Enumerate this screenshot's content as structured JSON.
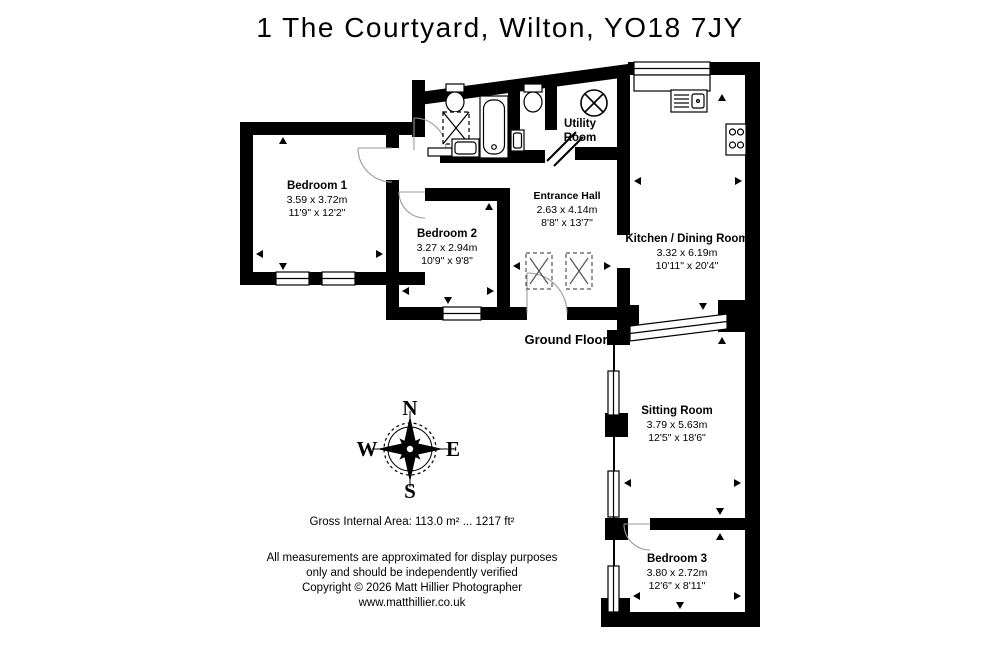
{
  "title": "1 The Courtyard, Wilton, YO18 7JY",
  "floor_label": "Ground Floor",
  "rooms": {
    "bedroom1": {
      "name": "Bedroom 1",
      "metric": "3.59 x 3.72m",
      "imperial": "11'9\" x 12'2\""
    },
    "bedroom2": {
      "name": "Bedroom 2",
      "metric": "3.27 x 2.94m",
      "imperial": "10'9\" x 9'8\""
    },
    "entrance": {
      "name": "Entrance Hall",
      "metric": "2.63 x 4.14m",
      "imperial": "8'8\" x 13'7\""
    },
    "utility": {
      "line1": "Utility",
      "line2": "Room"
    },
    "kitchen": {
      "name": "Kitchen / Dining Room",
      "metric": "3.32 x 6.19m",
      "imperial": "10'11\" x 20'4\""
    },
    "sitting": {
      "name": "Sitting Room",
      "metric": "3.79 x 5.63m",
      "imperial": "12'5\" x 18'6\""
    },
    "bedroom3": {
      "name": "Bedroom 3",
      "metric": "3.80 x 2.72m",
      "imperial": "12'6\" x 8'11\""
    }
  },
  "compass": {
    "n": "N",
    "e": "E",
    "s": "S",
    "w": "W"
  },
  "area_line": "Gross Internal Area: 113.0 m² ... 1217 ft²",
  "disclaimer": [
    "All measurements are approximated for display purposes",
    "only and should be independently verified",
    "Copyright © 2026 Matt Hillier Photographer",
    "www.matthillier.co.uk"
  ],
  "colors": {
    "wall": "#000000",
    "background": "#ffffff",
    "text": "#000000",
    "door_arc": "#9a9a9a"
  }
}
